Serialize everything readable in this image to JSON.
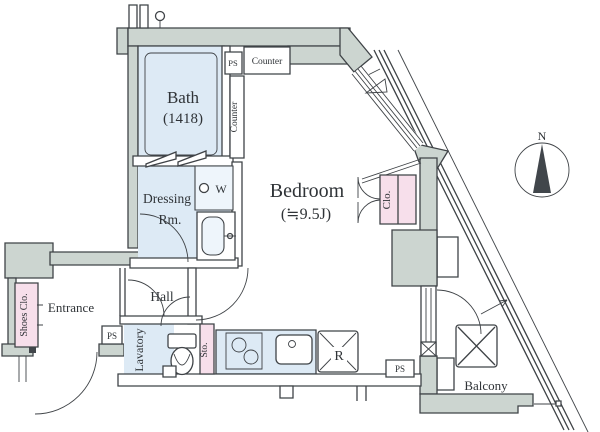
{
  "plan_type": "apartment-floor-plan",
  "colors": {
    "wall_fill": "#ccd5d0",
    "line": "#3f4347",
    "room_fill": "#ddeaf5",
    "closet_fill": "#f7dfeb",
    "fixture_fill": "#eef5fb",
    "text": "#2f3337"
  },
  "rooms": {
    "bath": {
      "name": "Bath",
      "size": "(1418)"
    },
    "bedroom": {
      "name": "Bedroom",
      "size": "(≒9.5J)"
    },
    "dressing_room": {
      "line1": "Dressing",
      "line2": "Rm."
    },
    "entrance": {
      "name": "Entrance"
    },
    "hall": {
      "name": "Hall"
    },
    "lavatory": {
      "name": "Lavatory"
    },
    "balcony": {
      "name": "Balcony"
    }
  },
  "storage": {
    "closet": "Clo.",
    "shoes": "Shoes Clo.",
    "sto": "Sto."
  },
  "fixtures": {
    "counter": "Counter",
    "washer": "W",
    "fridge": "R",
    "ps": "PS"
  },
  "compass": {
    "north": "N"
  }
}
